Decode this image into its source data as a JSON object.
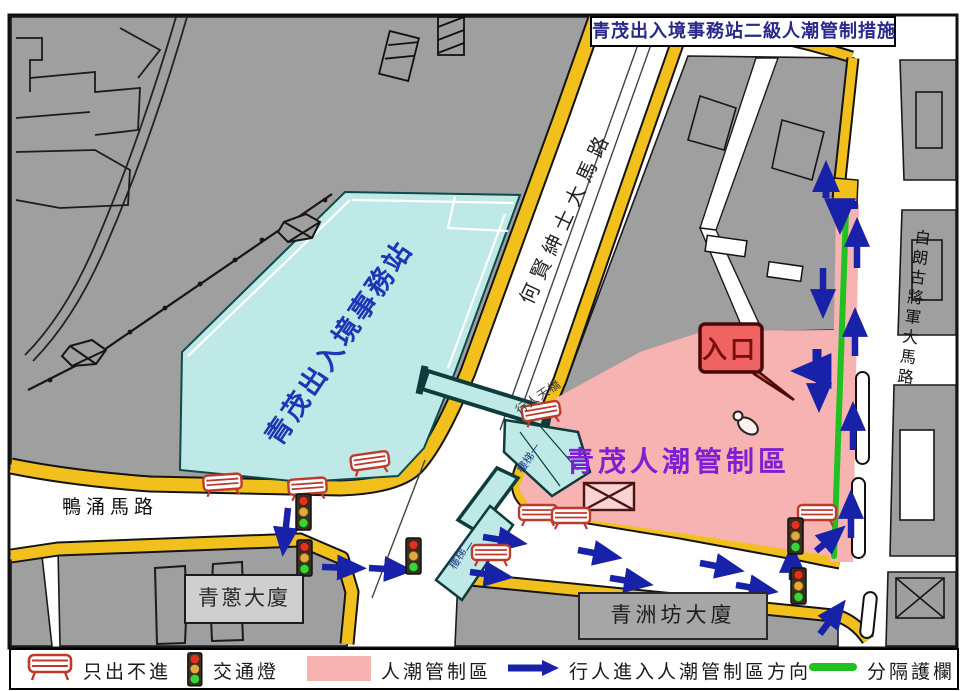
{
  "title": "青茂出入境事務站二級人潮管制措施",
  "labels": {
    "station": "青茂出入境事務站",
    "zone": "青茂人潮管制區",
    "entrance": "入口",
    "road_main": "何賢紳士大馬路",
    "road_right": "白朗古將軍大馬路",
    "road_bottom": "鴨涌馬路",
    "bridge": "行人天橋",
    "stair1": "樓梯一",
    "stair2": "樓梯二",
    "building1": "青蔥大廈",
    "building2": "青洲坊大廈"
  },
  "legend": {
    "items": [
      {
        "icon": "exit-only-barrier-icon",
        "label": "只出不進"
      },
      {
        "icon": "traffic-light-icon",
        "label": "交通燈"
      },
      {
        "icon": "crowd-zone-swatch",
        "label": "人潮管制區"
      },
      {
        "icon": "pedestrian-arrow-icon",
        "label": "行人進入人潮管制區方向"
      },
      {
        "icon": "separation-fence-icon",
        "label": "分隔護欄"
      }
    ]
  },
  "colors": {
    "arrow_blue": "#1822a8",
    "zone_pink": "#f7b2b2",
    "station_cyan": "#bfe9e6",
    "curb_yellow": "#f2c01d",
    "fence_green": "#21c121",
    "block_gray": "#9f9f9f",
    "title_navy": "#28288e",
    "zone_label_purple": "#7d1fd2",
    "entrance_red": "#ef6363",
    "barrier_red": "#c0392b"
  }
}
